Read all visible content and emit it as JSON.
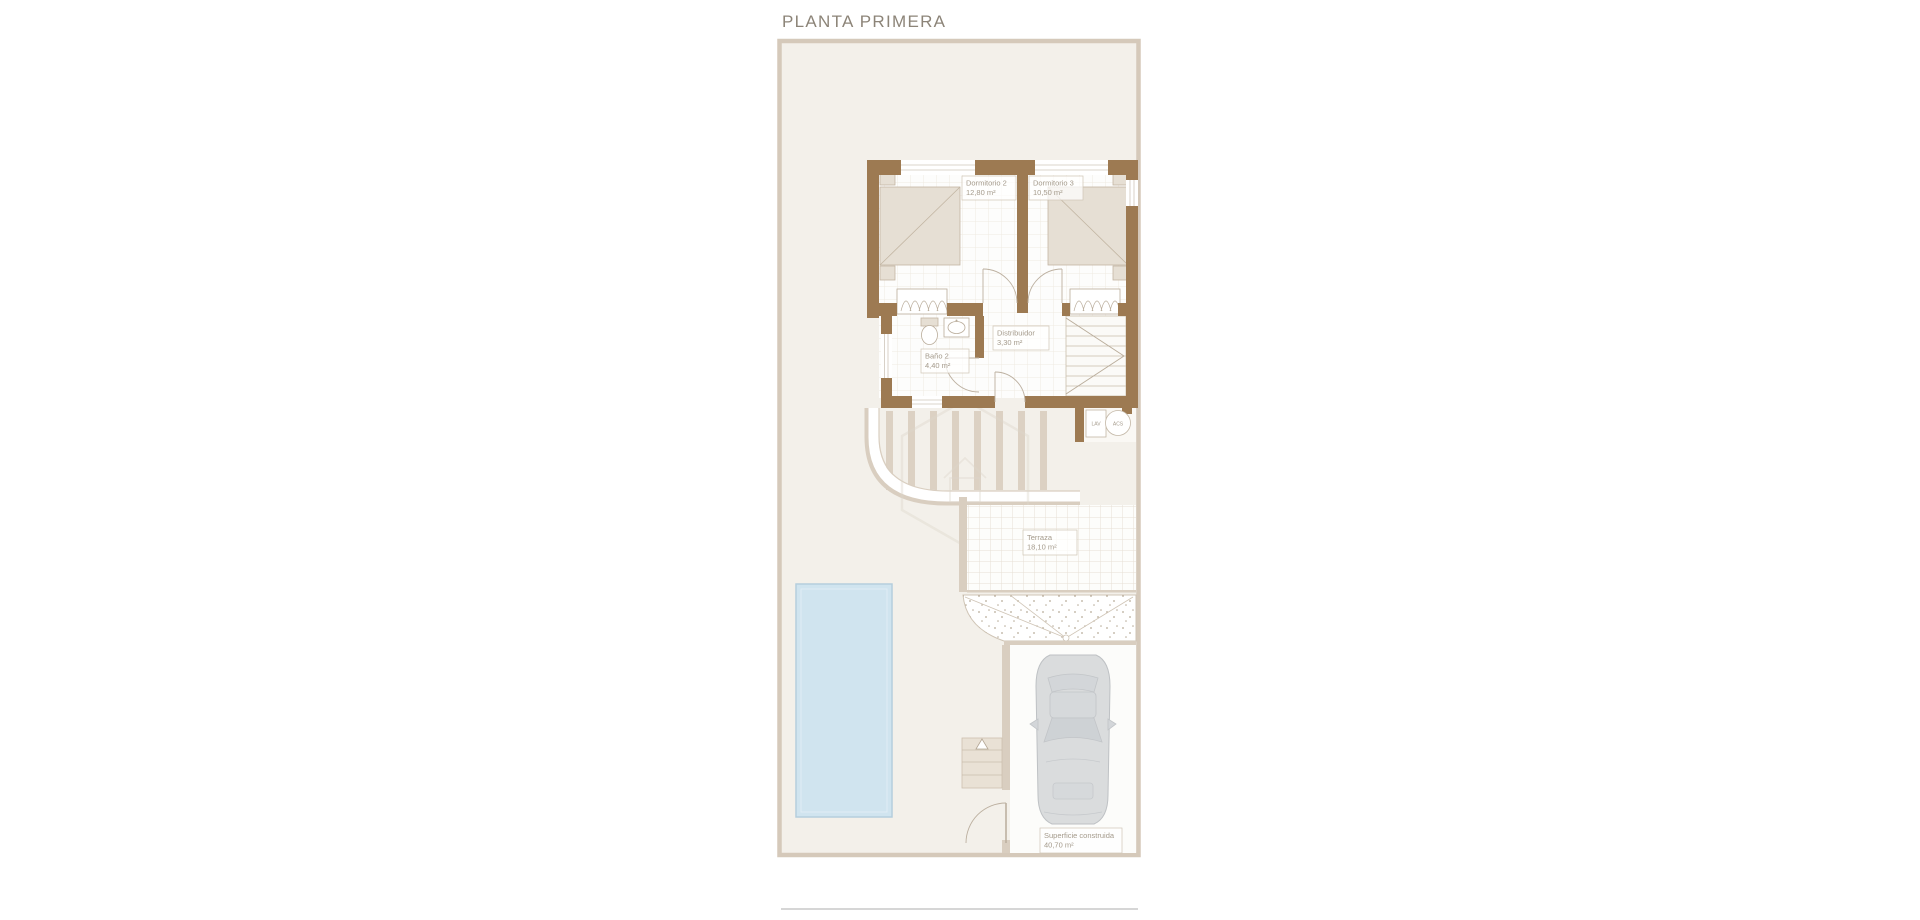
{
  "title": "PLANTA PRIMERA",
  "colors": {
    "wall_brown": "#9d7a52",
    "plot_background": "#f3f0ea",
    "plot_border": "#d5c9ba",
    "furniture_beige": "#e6dfd4",
    "pergola_beige": "#dcd1c3",
    "pool_blue": "#d0e4ef",
    "car_gray": "#dadcdd",
    "label_text": "#a49a8b",
    "title_text": "#8c8478"
  },
  "plan": {
    "rooms": [
      {
        "name": "Dormitorio 2",
        "area": "12,80 m²"
      },
      {
        "name": "Dormitorio 3",
        "area": "10,50 m²"
      },
      {
        "name": "Distribuidor",
        "area": "3,30 m²"
      },
      {
        "name": "Baño 2",
        "area": "4,40 m²"
      },
      {
        "name": "Terraza",
        "area": "18,10 m²"
      }
    ],
    "summary": {
      "label": "Superficie construida",
      "value": "40,70 m²"
    },
    "appliances": {
      "washer": "LAV",
      "heater": "ACS"
    }
  }
}
